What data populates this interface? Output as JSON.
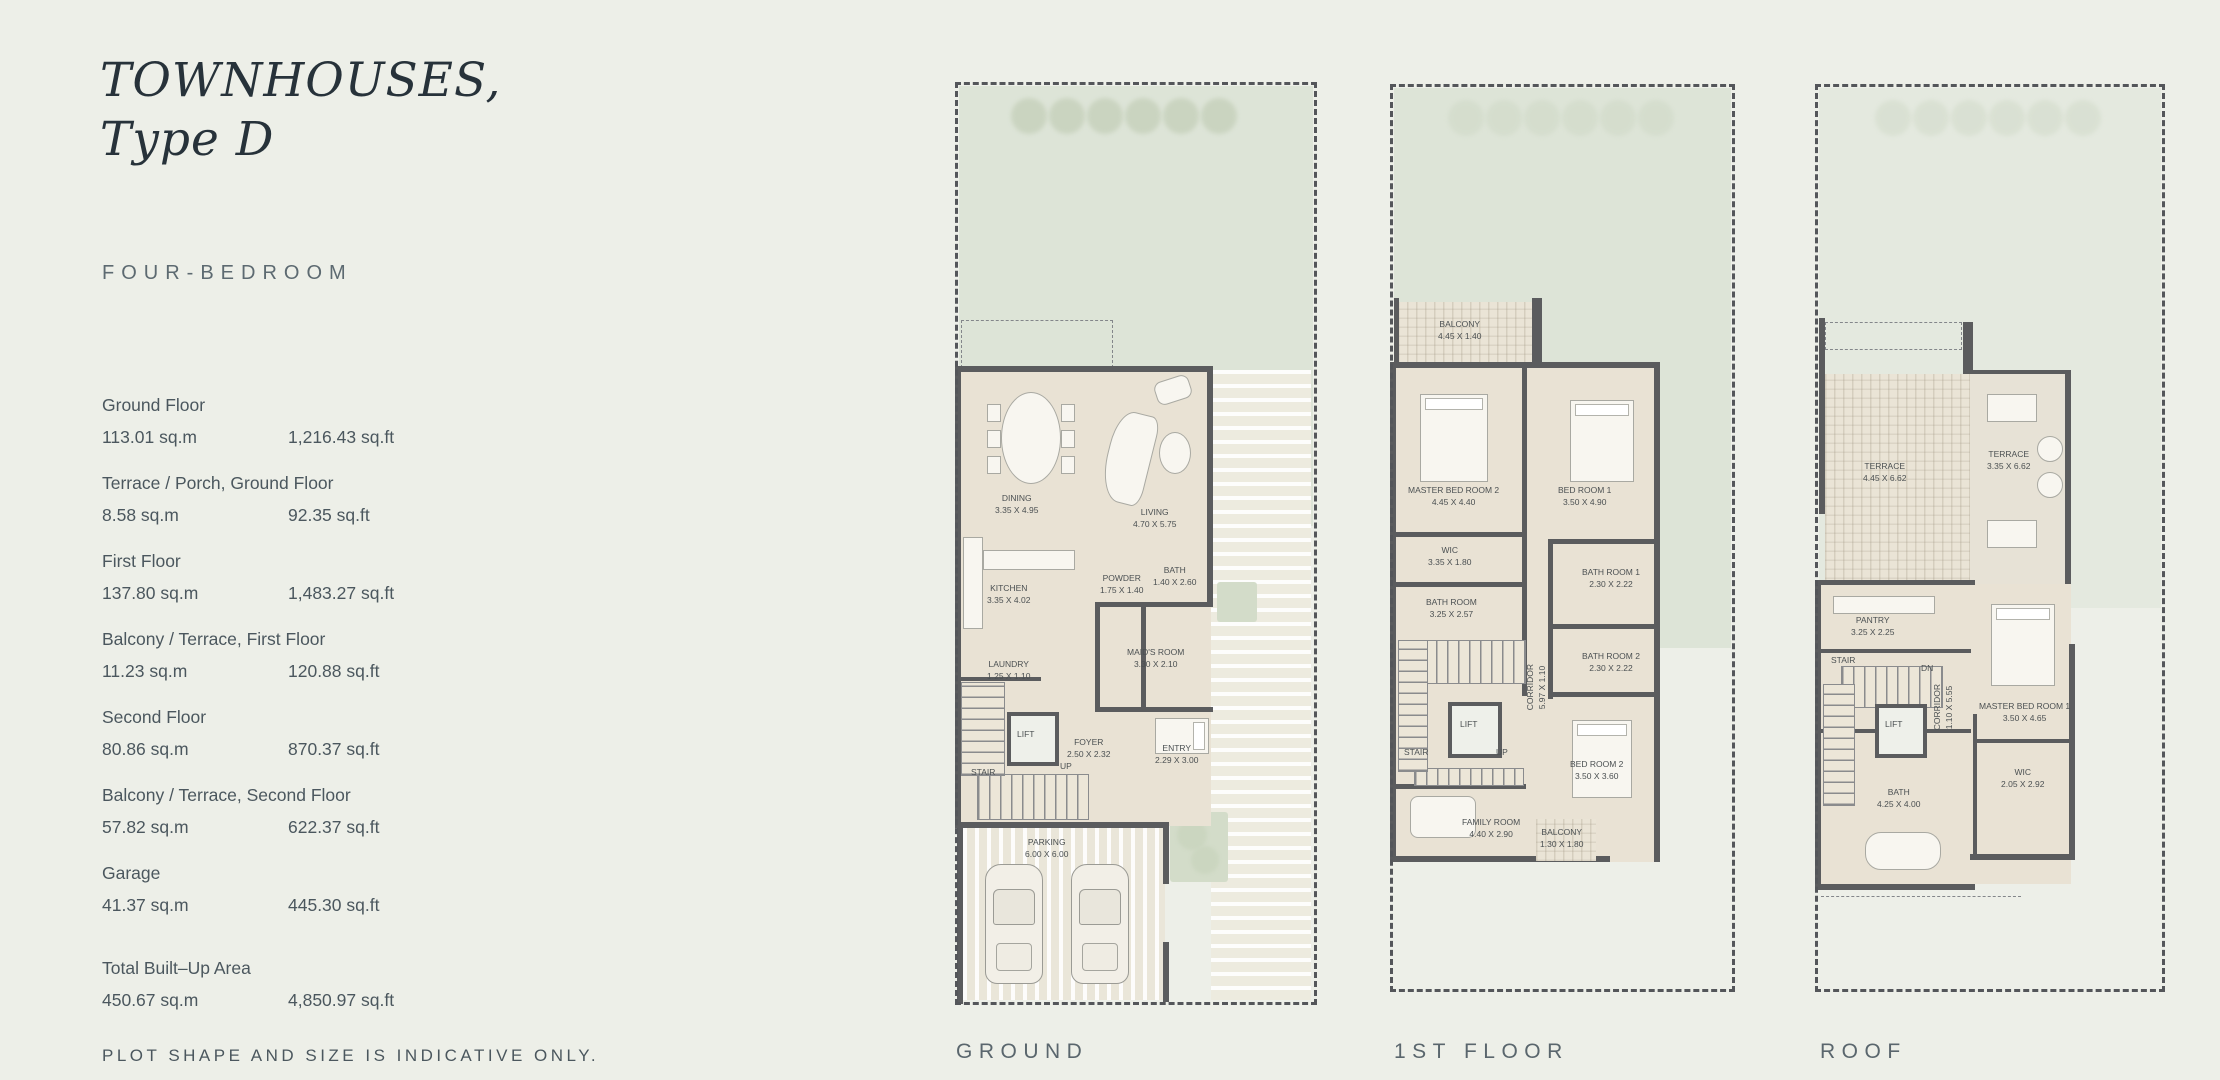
{
  "page": {
    "title_line1": "TOWNHOUSES,",
    "title_line2": "Type D",
    "subtitle": "FOUR-BEDROOM",
    "footnote": "PLOT SHAPE AND SIZE IS INDICATIVE ONLY."
  },
  "colors": {
    "background": "#edefe8",
    "garden_green": "#dde4d7",
    "floor_beige": "#e9e2d4",
    "wall_gray": "#5b5c5e",
    "text_primary": "#27323a",
    "text_secondary": "#5d6a71"
  },
  "areas": [
    {
      "label": "Ground Floor",
      "sqm": "113.01 sq.m",
      "sqft": "1,216.43 sq.ft"
    },
    {
      "label": "Terrace / Porch, Ground Floor",
      "sqm": "8.58 sq.m",
      "sqft": "92.35 sq.ft"
    },
    {
      "label": "First Floor",
      "sqm": "137.80 sq.m",
      "sqft": "1,483.27 sq.ft"
    },
    {
      "label": "Balcony / Terrace, First Floor",
      "sqm": "11.23 sq.m",
      "sqft": "120.88 sq.ft"
    },
    {
      "label": "Second Floor",
      "sqm": "80.86 sq.m",
      "sqft": "870.37 sq.ft"
    },
    {
      "label": "Balcony / Terrace, Second Floor",
      "sqm": "57.82 sq.m",
      "sqft": "622.37 sq.ft"
    },
    {
      "label": "Garage",
      "sqm": "41.37 sq.m",
      "sqft": "445.30 sq.ft"
    }
  ],
  "total": {
    "label": "Total Built–Up Area",
    "sqm": "450.67 sq.m",
    "sqft": "4,850.97 sq.ft"
  },
  "plans": [
    {
      "caption": "GROUND",
      "rooms": [
        {
          "name": "DINING",
          "dims": "3.35 X 4.95"
        },
        {
          "name": "LIVING",
          "dims": "4.70 X 5.75"
        },
        {
          "name": "KITCHEN",
          "dims": "3.35 X 4.02"
        },
        {
          "name": "LAUNDRY",
          "dims": "1.25 X 1.10"
        },
        {
          "name": "POWDER",
          "dims": "1.75 X 1.40"
        },
        {
          "name": "BATH",
          "dims": "1.40 X 2.60"
        },
        {
          "name": "MAID'S ROOM",
          "dims": "3.30 X 2.10"
        },
        {
          "name": "LIFT",
          "dims": ""
        },
        {
          "name": "STAIR",
          "dims": ""
        },
        {
          "name": "UP",
          "dims": ""
        },
        {
          "name": "FOYER",
          "dims": "2.50 X 2.32"
        },
        {
          "name": "ENTRY",
          "dims": "2.29 X 3.00"
        },
        {
          "name": "PARKING",
          "dims": "6.00 X 6.00"
        }
      ]
    },
    {
      "caption": "1ST FLOOR",
      "rooms": [
        {
          "name": "BALCONY",
          "dims": "4.45 X 1.40"
        },
        {
          "name": "MASTER BED ROOM 2",
          "dims": "4.45 X 4.40"
        },
        {
          "name": "BED ROOM 1",
          "dims": "3.50 X 4.90"
        },
        {
          "name": "WIC",
          "dims": "3.35 X 1.80"
        },
        {
          "name": "BATH ROOM",
          "dims": "3.25 X 2.57"
        },
        {
          "name": "BATH ROOM 1",
          "dims": "2.30 X 2.22"
        },
        {
          "name": "BATH ROOM 2",
          "dims": "2.30 X 2.22"
        },
        {
          "name": "CORRIDOR",
          "dims": "5.97 X 1.10"
        },
        {
          "name": "LIFT",
          "dims": ""
        },
        {
          "name": "STAIR",
          "dims": ""
        },
        {
          "name": "UP",
          "dims": ""
        },
        {
          "name": "BED ROOM 2",
          "dims": "3.50 X 3.60"
        },
        {
          "name": "FAMILY ROOM",
          "dims": "4.40 X 2.90"
        },
        {
          "name": "BALCONY",
          "dims": "1.30 X 1.80"
        }
      ]
    },
    {
      "caption": "ROOF",
      "rooms": [
        {
          "name": "TERRACE",
          "dims": "4.45 X 6.62"
        },
        {
          "name": "TERRACE",
          "dims": "3.35 X 6.62"
        },
        {
          "name": "PANTRY",
          "dims": "3.25 X 2.25"
        },
        {
          "name": "STAIR",
          "dims": ""
        },
        {
          "name": "DN",
          "dims": ""
        },
        {
          "name": "LIFT",
          "dims": ""
        },
        {
          "name": "CORRIDOR",
          "dims": "1.10 X 5.55"
        },
        {
          "name": "MASTER BED ROOM 1",
          "dims": "3.50 X 4.65"
        },
        {
          "name": "WIC",
          "dims": "2.05 X 2.92"
        },
        {
          "name": "BATH",
          "dims": "4.25 X 4.00"
        }
      ]
    }
  ]
}
